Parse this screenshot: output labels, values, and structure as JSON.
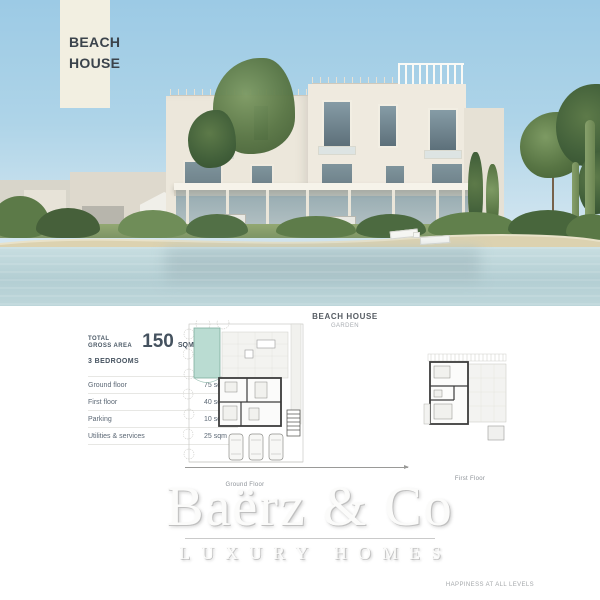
{
  "photo": {
    "badge": {
      "line1": "BEACH",
      "line2": "HOUSE"
    }
  },
  "details": {
    "total_label_line1": "TOTAL",
    "total_label_line2": "GROSS AREA",
    "total_value": "150",
    "total_unit": "SQM",
    "bedrooms": "3 BEDROOMS",
    "rows": [
      {
        "label": "Ground floor",
        "value": "75 sqm"
      },
      {
        "label": "First floor",
        "value": "40 sqm"
      },
      {
        "label": "Parking",
        "value": "10 sqm"
      },
      {
        "label": "Utilities & services",
        "value": "25 sqm"
      }
    ]
  },
  "plan_header": {
    "title": "BEACH HOUSE",
    "subtitle": "GARDEN"
  },
  "plans": {
    "ground_label": "Ground Floor",
    "first_label": "First Floor"
  },
  "watermark": {
    "brand": "Baërz & Co",
    "tagline": "LUXURY HOMES"
  },
  "footer_note": "HAPPINESS AT ALL LEVELS",
  "colors": {
    "sky": "#aed4e8",
    "water": "#b3ced3",
    "sand": "#dcd2b0",
    "building_cream": "#ece7db",
    "pool_teal": "#badcd2",
    "text_dark": "#45525f",
    "badge_bg": "#f2efe1"
  }
}
